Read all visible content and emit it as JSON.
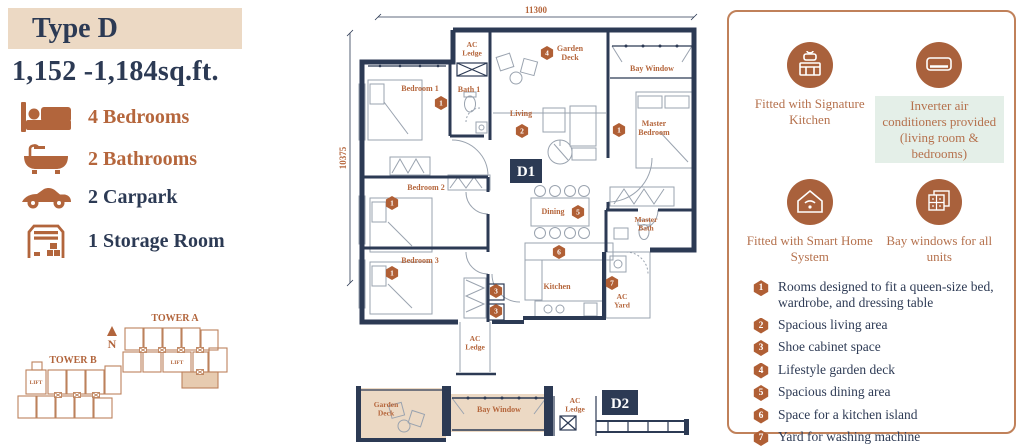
{
  "colors": {
    "navy": "#2c3a54",
    "rust": "#b5663c",
    "badge_rust": "#b05f35",
    "tan": "#ecd9c4",
    "mint": "#e4efe8",
    "panel_border": "#c0815a"
  },
  "left": {
    "type_label": "Type D",
    "area": "1,152 -1,184sq.ft.",
    "features": [
      {
        "icon": "bed-icon",
        "label": "4 Bedrooms"
      },
      {
        "icon": "bathtub-icon",
        "label": "2 Bathrooms"
      },
      {
        "icon": "car-icon",
        "label": "2 Carpark"
      },
      {
        "icon": "storage-icon",
        "label": "1 Storage Room"
      }
    ],
    "site_plan": {
      "tower_a": "TOWER A",
      "tower_b": "TOWER B",
      "lift_a": "LIFT",
      "lift_b": "LIFT",
      "north": "N"
    }
  },
  "floor_plan": {
    "dims": {
      "top": "11300",
      "left": "10375"
    },
    "units": {
      "d1": "D1",
      "d2": "D2"
    },
    "rooms": {
      "bedroom1": "Bedroom 1",
      "ac_ledge_top": "AC\nLedge",
      "bath1": "Bath 1",
      "garden_deck": "Garden\nDeck",
      "bay_window": "Bay Window",
      "living": "Living",
      "master_bedroom": "Master\nBedroom",
      "bedroom2": "Bedroom 2",
      "dining": "Dining",
      "master_bath": "Master\nBath",
      "bedroom3": "Bedroom 3",
      "kitchen": "Kitchen",
      "ac_yard": "AC\nYard",
      "ac_ledge_bottom": "AC\nLedge",
      "d2_garden_deck": "Garden\nDeck",
      "d2_bay_window": "Bay Window",
      "d2_ac_ledge": "AC\nLedge"
    },
    "plan_badges": {
      "bedroom1": "1",
      "garden_deck": "4",
      "living": "2",
      "master_bedroom": "1",
      "bedroom2": "1",
      "dining": "5",
      "bedroom3": "1",
      "shoe_a": "3",
      "shoe_b": "3",
      "kitchen": "6",
      "ac_yard": "7"
    }
  },
  "right_panel": {
    "features": [
      {
        "icon": "kitchen-icon",
        "label": "Fitted with Signature Kitchen",
        "highlight": false
      },
      {
        "icon": "air-conditioner-icon",
        "label": "Inverter air conditioners provided (living room & bedrooms)",
        "highlight": true
      },
      {
        "icon": "smart-home-icon",
        "label": "Fitted with Smart Home System",
        "highlight": false
      },
      {
        "icon": "bay-window-icon",
        "label": "Bay windows for all units",
        "highlight": false
      }
    ],
    "legend": [
      {
        "num": "1",
        "text": "Rooms designed to fit a queen-size bed, wardrobe, and dressing table"
      },
      {
        "num": "2",
        "text": "Spacious living area"
      },
      {
        "num": "3",
        "text": "Shoe cabinet space"
      },
      {
        "num": "4",
        "text": "Lifestyle garden deck"
      },
      {
        "num": "5",
        "text": "Spacious dining area"
      },
      {
        "num": "6",
        "text": "Space for a kitchen island"
      },
      {
        "num": "7",
        "text": "Yard for washing machine"
      }
    ]
  }
}
